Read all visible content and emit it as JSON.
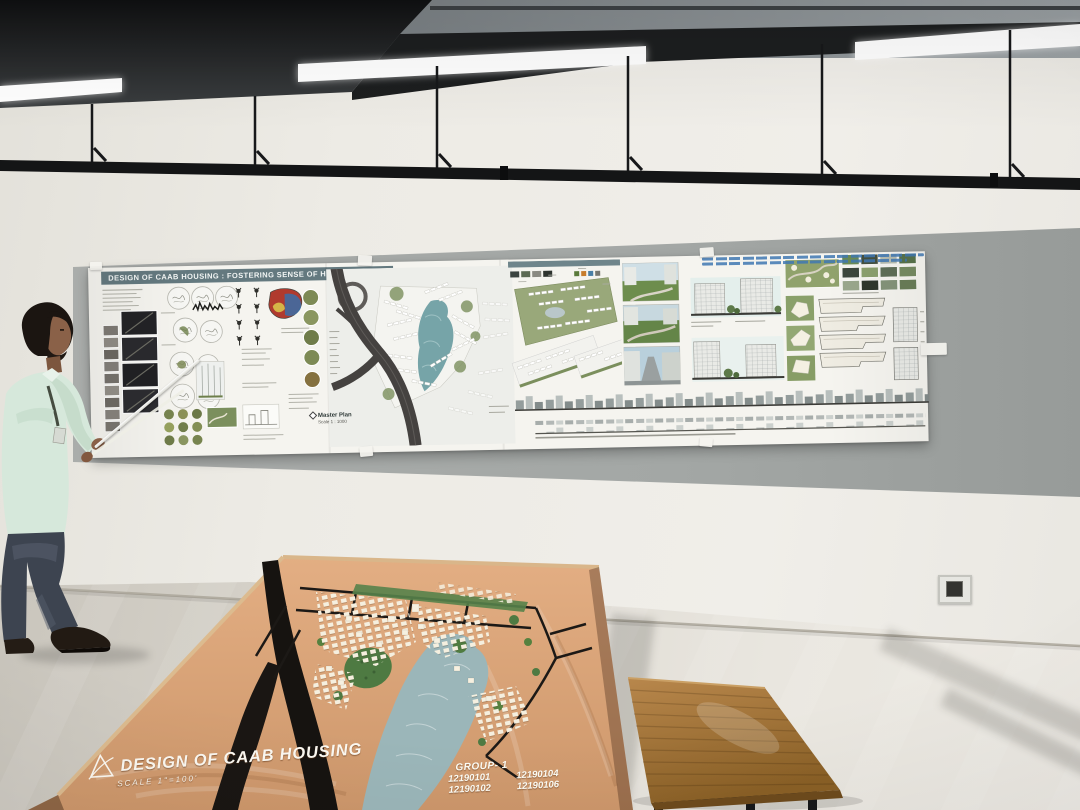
{
  "scene": {
    "setting": "Architecture studio presentation room with wall-mounted project board and physical site model",
    "wall_panel_color": "#a3a7a5",
    "floor_color": "#e0ddd5"
  },
  "presentation_board": {
    "title": "DESIGN OF CAAB HOUSING : FOSTERING SENSE OF HARMONY",
    "header_color": "#64797f",
    "master_plan": {
      "label": "Master Plan",
      "scale": "Scale 1 : 1000"
    }
  },
  "site_model": {
    "title": "DESIGN OF CAAB HOUSING",
    "scale": "SCALE 1\"=100'",
    "base_color": "#d9a679",
    "water_color": "#9bb6b9",
    "group": {
      "label": "GROUP- 1",
      "ids": [
        "12190101",
        "12190104",
        "12190102",
        "12190106"
      ]
    }
  },
  "furniture": {
    "bench_color": "#a87c42"
  }
}
